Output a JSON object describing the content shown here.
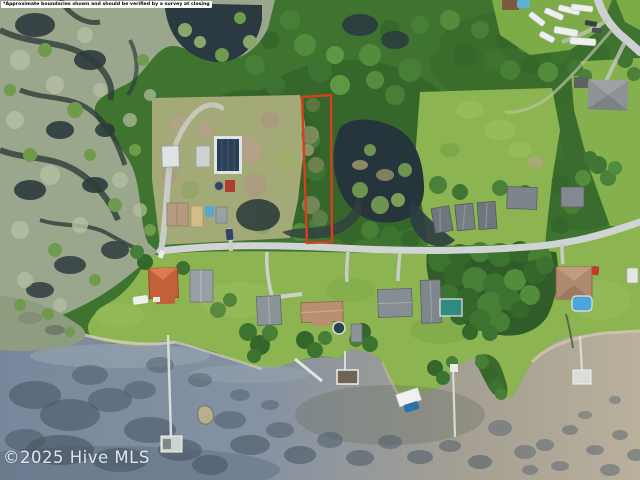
{
  "overlay": {
    "disclaimer": "*Approximate boundaries shown and should be verified by a survey at closing",
    "watermark": "©2025 Hive MLS"
  },
  "boundary": {
    "stroke": "#d6401c",
    "label": "approximate-property-boundary"
  },
  "palette": {
    "forest": "#3f7330",
    "lawn": "#8cb551",
    "marsh": "#9aa78d",
    "pond": "#26343c",
    "road": "#d0d4d5",
    "water_left": "#7b8a9e",
    "water_right": "#b7ae9a"
  }
}
